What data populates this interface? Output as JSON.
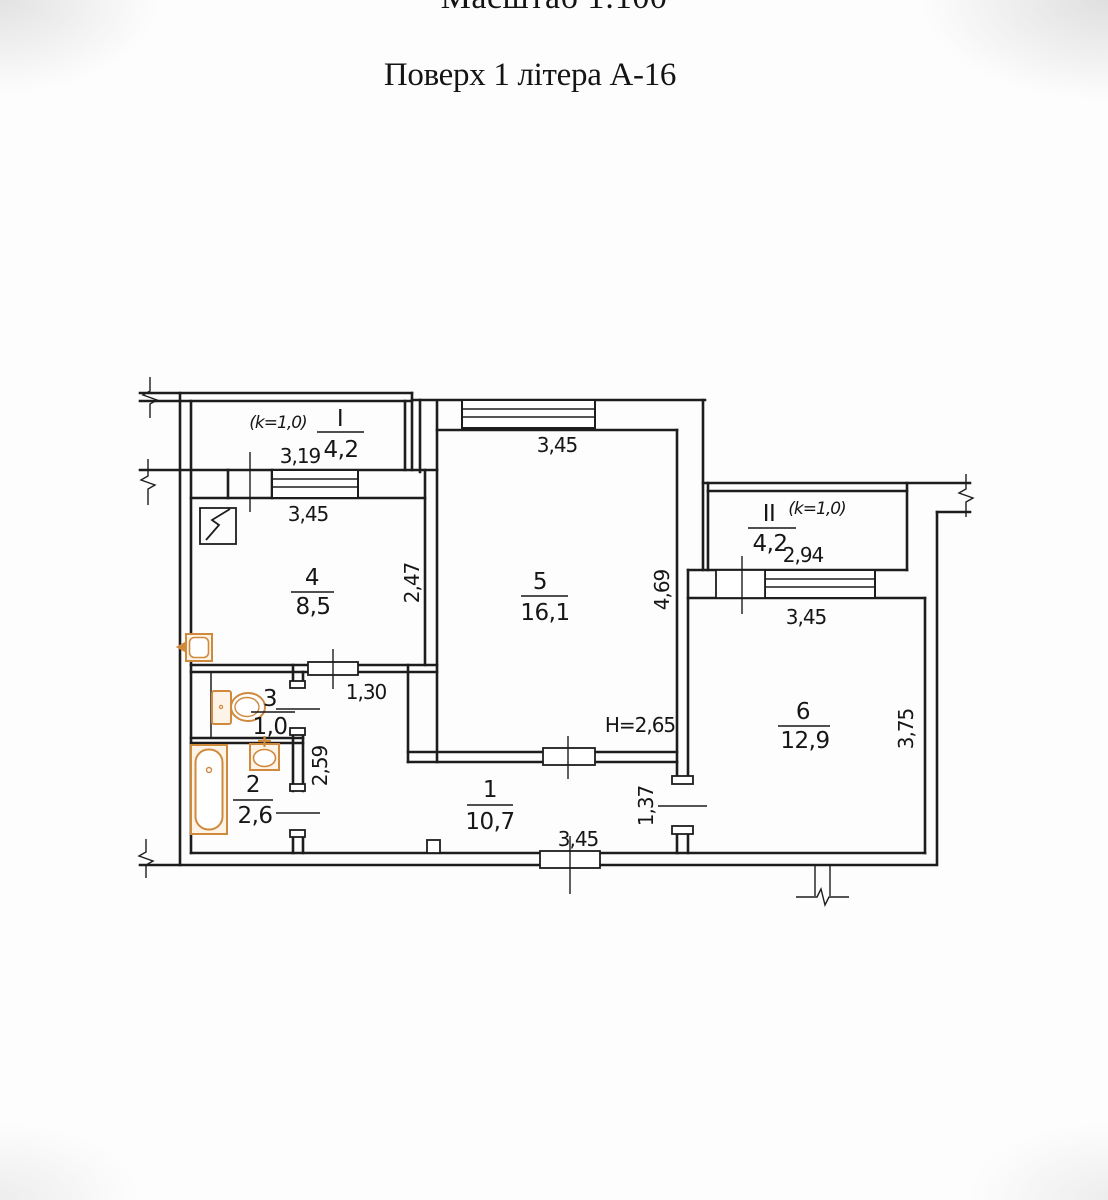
{
  "page": {
    "scale_title": "Масштаб 1:100",
    "floor_title": "Поверх 1 літера А-16"
  },
  "plan": {
    "colors": {
      "ink": "#1d1d1d",
      "fixture": "#cf8a3e"
    },
    "rooms": [
      {
        "number": "1",
        "area": "10,7"
      },
      {
        "number": "2",
        "area": "2,6"
      },
      {
        "number": "3",
        "area": "1,0"
      },
      {
        "number": "4",
        "area": "8,5"
      },
      {
        "number": "5",
        "area": "16,1"
      },
      {
        "number": "6",
        "area": "12,9"
      }
    ],
    "balconies": [
      {
        "number": "I",
        "area": "4,2",
        "coef": "(k=1,0)"
      },
      {
        "number": "II",
        "area": "4,2",
        "coef": "(k=1,0)"
      }
    ],
    "dims": {
      "b1_width": "3,19",
      "kitchen_top": "3,45",
      "kitchen_right": "2,47",
      "room5_top": "3,45",
      "room5_right": "4,69",
      "b2_width": "2,94",
      "room6_top": "3,45",
      "room6_right": "3,75",
      "corridor_door": "1,30",
      "hall_left": "2,59",
      "room6_door": "1,37",
      "entrance_bottom": "3,45",
      "height_note": "H=2,65"
    }
  }
}
